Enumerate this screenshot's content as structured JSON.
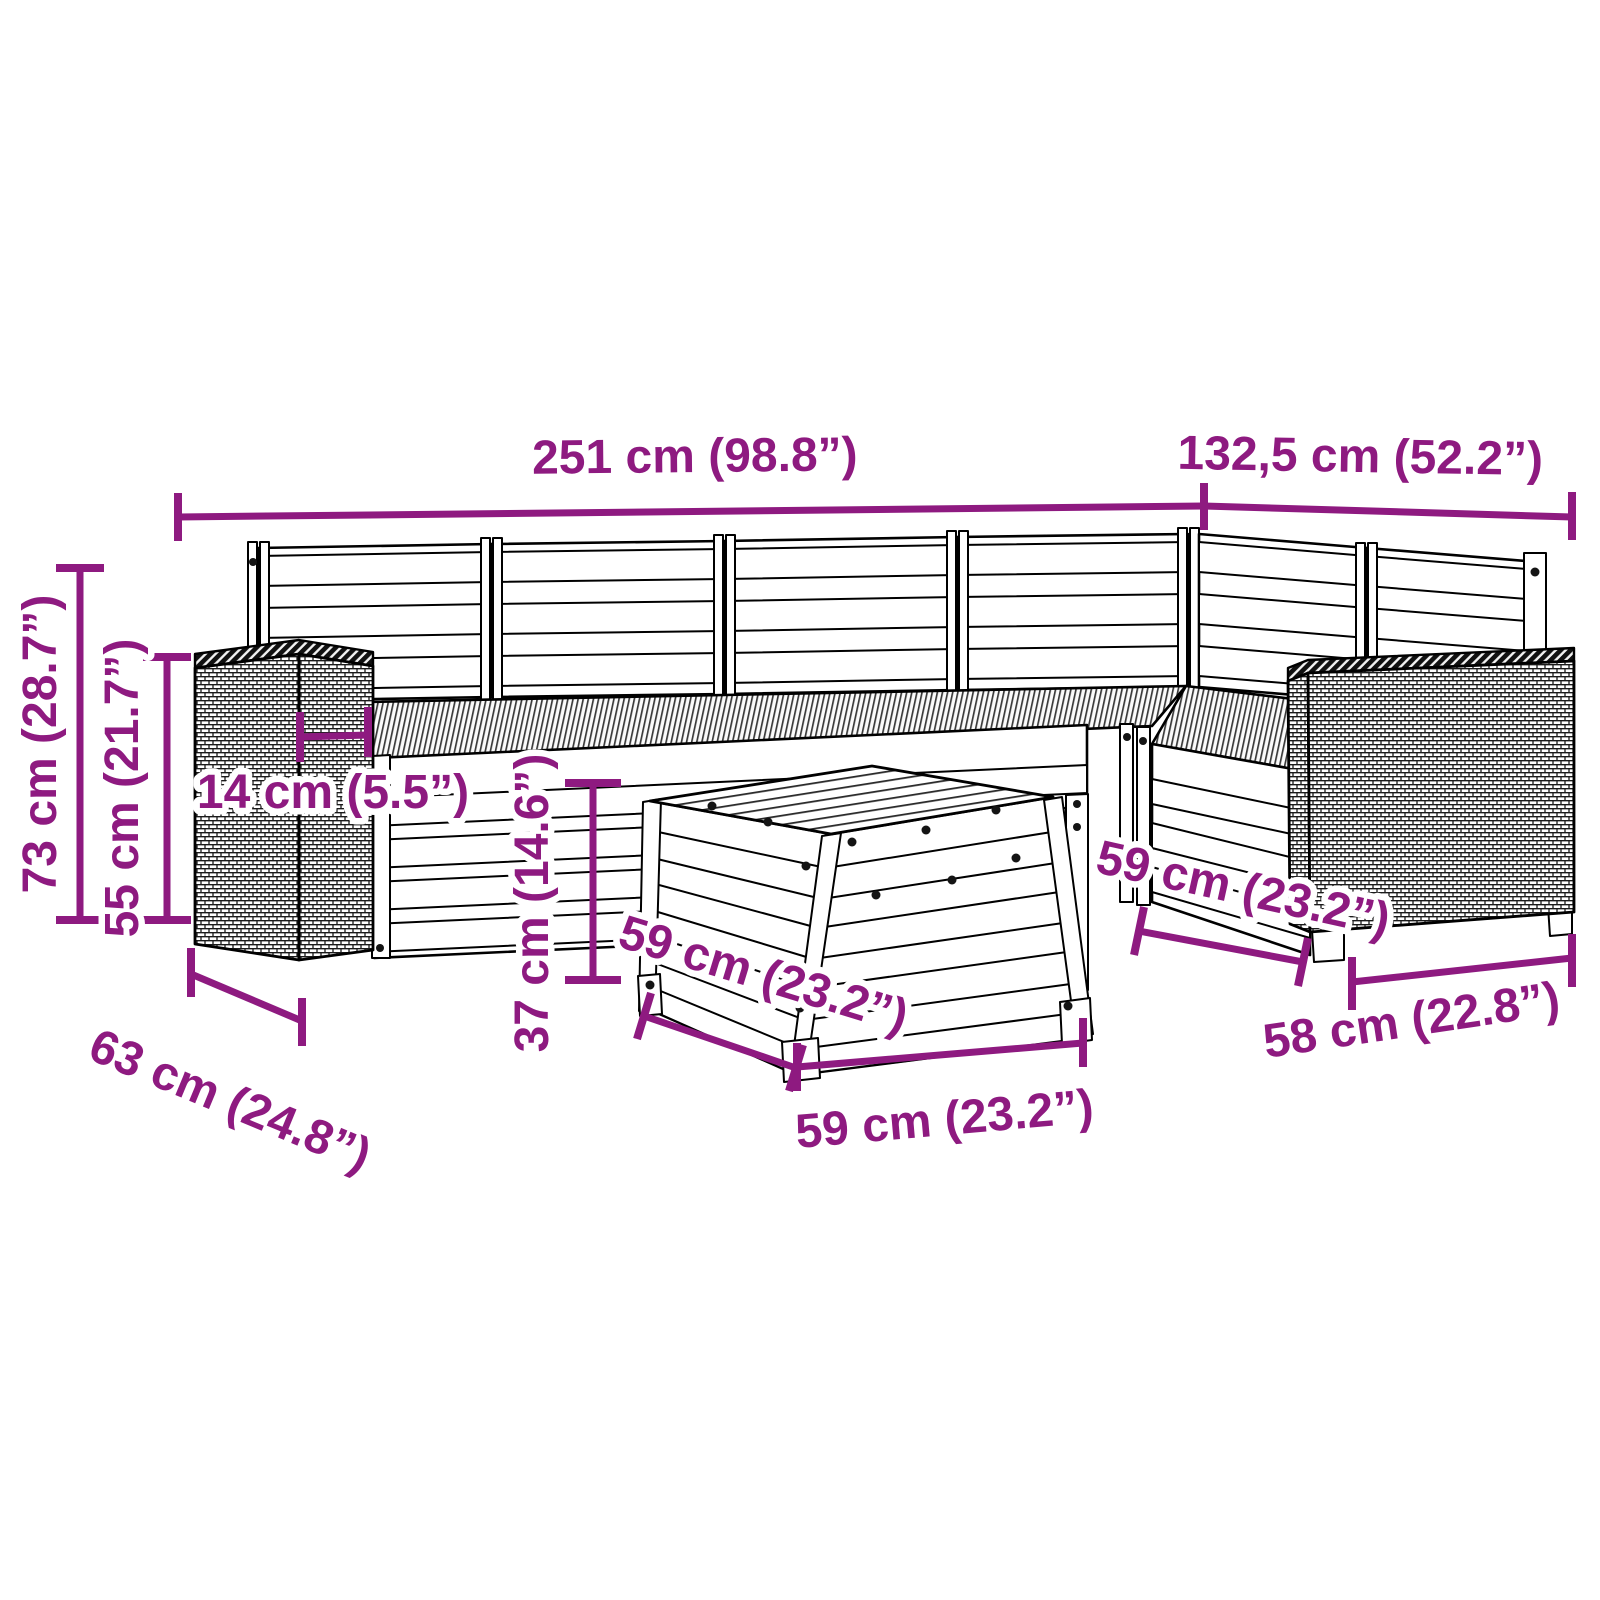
{
  "figure": {
    "type": "product-dimension-diagram",
    "subject": "7-piece garden lounge sofa set with rattan armrests and footstool table",
    "background_color": "#ffffff",
    "line_color": "#000000",
    "dimension_color": "#8e1a80"
  },
  "dimensions": {
    "total_width": "251 cm (98.8”)",
    "total_depth": "132,5 cm (52.2”)",
    "back_height": "73 cm (28.7”)",
    "armrest_height": "55 cm (21.7”)",
    "armrest_top_width": "14 cm (5.5”)",
    "table_height": "37 cm (14.6”)",
    "table_side_depth": "59 cm (23.2”)",
    "table_front_width": "59 cm (23.2”)",
    "seat_depth_right": "59 cm (23.2”)",
    "seat_width_right": "58 cm (22.8”)",
    "armrest_depth": "63 cm (24.8”)"
  }
}
